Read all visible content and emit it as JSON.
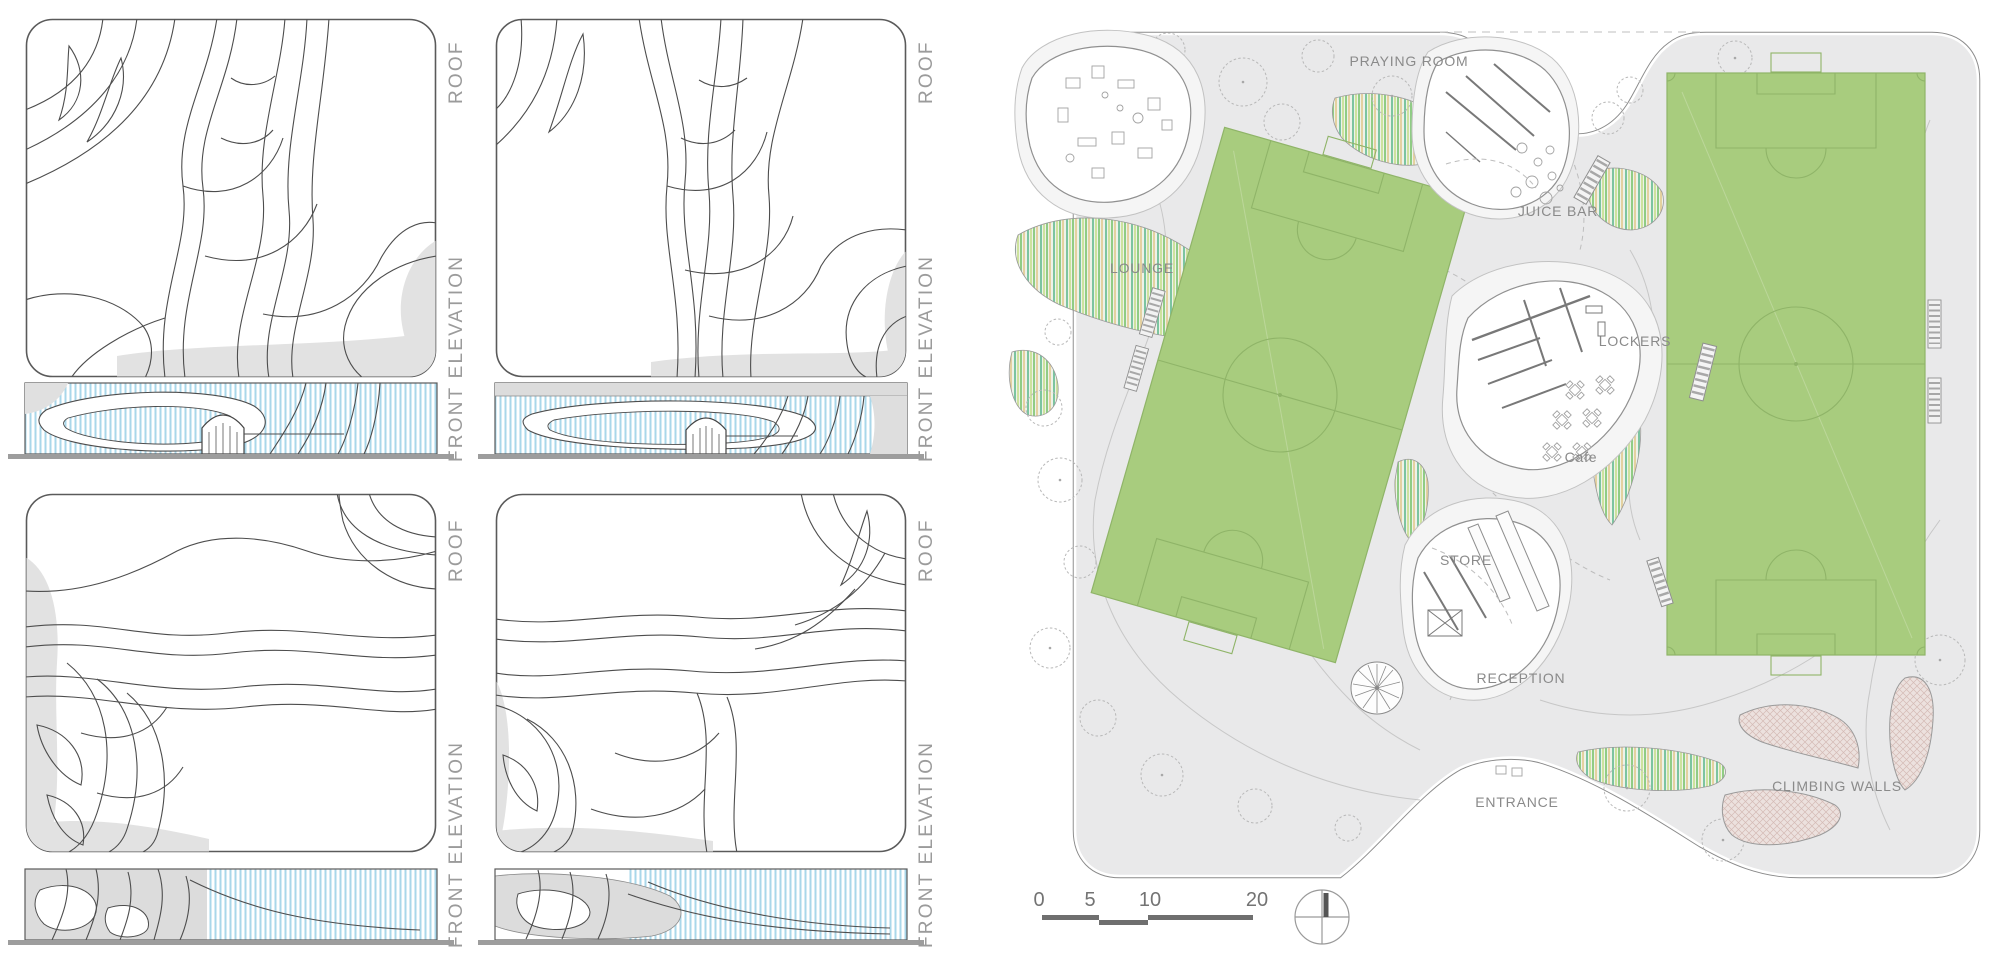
{
  "panels": [
    {
      "id": "top-left",
      "roof_label": "ROOF",
      "elevation_label": "FRONT ELEVATION"
    },
    {
      "id": "top-right",
      "roof_label": "ROOF",
      "elevation_label": "FRONT ELEVATION"
    },
    {
      "id": "bottom-left",
      "roof_label": "ROOF",
      "elevation_label": "FRONT ELEVATION"
    },
    {
      "id": "bottom-right",
      "roof_label": "ROOF",
      "elevation_label": "FRONT ELEVATION"
    }
  ],
  "plan": {
    "labels": {
      "praying_room": "PRAYING ROOM",
      "juice_bar": "JUICE BAR",
      "lounge": "LOUNGE",
      "lockers": "LOCKERS",
      "cafe": "Cafe",
      "store": "STORE",
      "reception": "RECEPTION",
      "entrance": "ENTRANCE",
      "climbing_walls": "CLIMBING WALLS"
    },
    "scale_bar": {
      "ticks": [
        "0",
        "5",
        "10",
        "20"
      ]
    },
    "icons": {
      "north_arrow": "compass-circle-with-needle",
      "tree": "scalloped-circle-with-center-dot",
      "stairs": "ladder-rungs",
      "football_pitch": "rectangle-with-center-circle-and-penalty-boxes"
    }
  },
  "colors": {
    "pitch_green": "#a8cc7e",
    "pitch_line_green": "#8fb468",
    "site_ground_gray": "#e9e9ea",
    "glazing_stripe_blue": "#a9d7ea",
    "plan_label_gray": "#8a8a8a",
    "panel_label_gray": "#9b9b9b",
    "climbing_wall_pink": "#ece1de",
    "roof_blob_gray": "#e2e2e2",
    "ground_line_gray": "#9d9d9d"
  }
}
